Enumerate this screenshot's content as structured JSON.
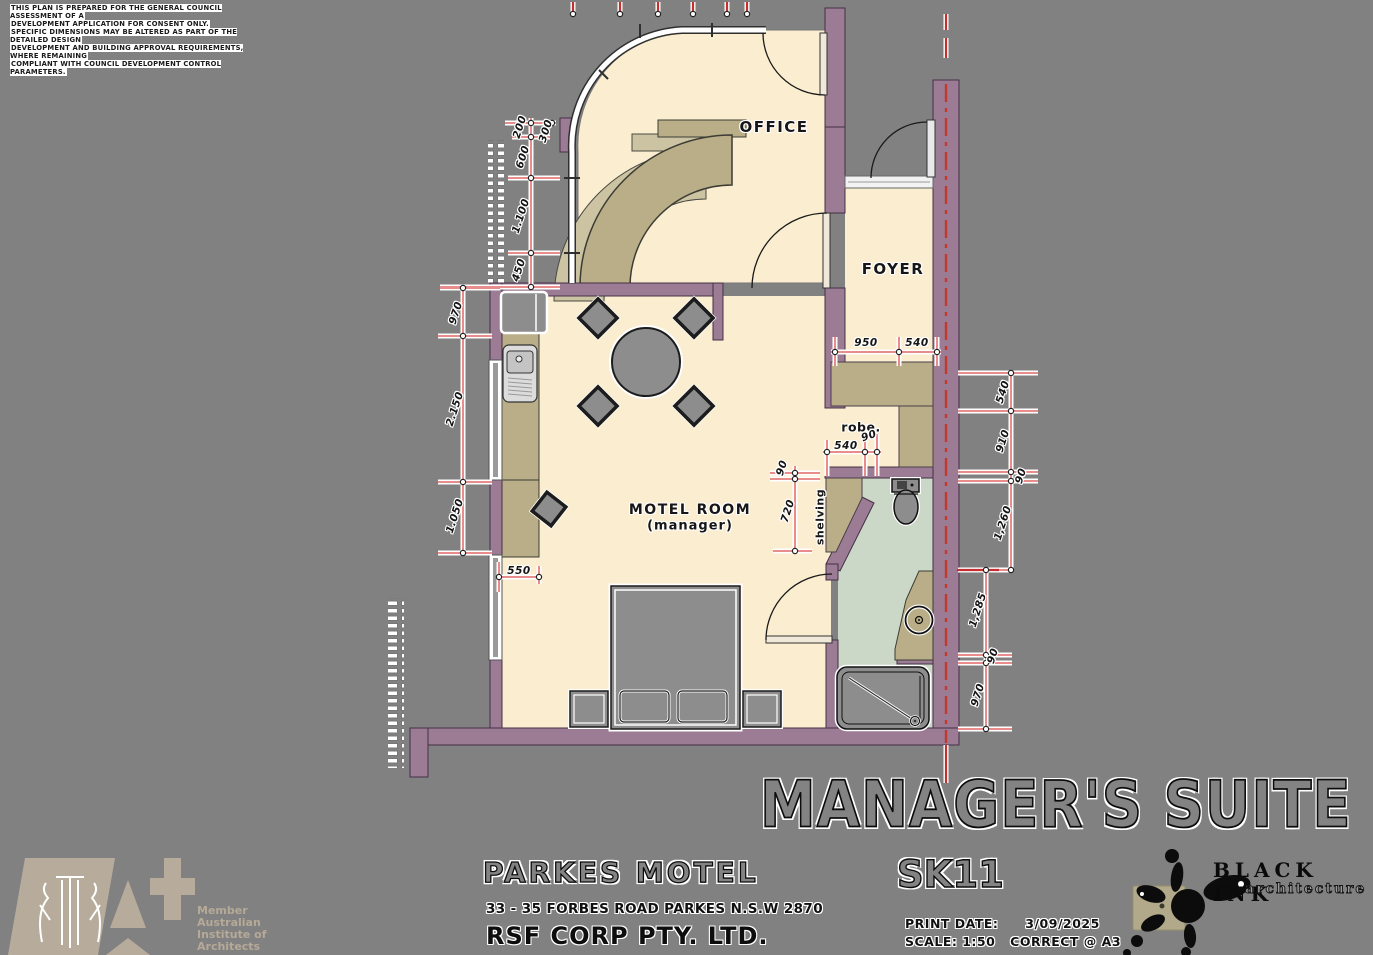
{
  "disclaimer_lines": [
    "THIS PLAN IS PREPARED FOR THE GENERAL COUNCIL ASSESSMENT OF A",
    "DEVELOPMENT APPLICATION FOR CONSENT ONLY.",
    "SPECIFIC DIMENSIONS MAY BE ALTERED AS PART OF THE DETAILED DESIGN",
    "DEVELOPMENT AND BUILDING APPROVAL REQUIREMENTS, WHERE REMAINING",
    "COMPLIANT WITH COUNCIL DEVELOPMENT CONTROL PARAMETERS."
  ],
  "plan": {
    "room_labels": {
      "office": "OFFICE",
      "foyer": "FOYER",
      "motel_room": "MOTEL ROOM",
      "motel_room_sub": "(manager)",
      "robe": "robe.",
      "shelving": "shelving"
    },
    "dimension_labels": [
      {
        "text": "200",
        "x": 520,
        "y": 127,
        "rot": -72
      },
      {
        "text": "300",
        "x": 546,
        "y": 131,
        "rot": -72
      },
      {
        "text": "600",
        "x": 523,
        "y": 157,
        "rot": -72
      },
      {
        "text": "1.100",
        "x": 521,
        "y": 216,
        "rot": -72
      },
      {
        "text": "450",
        "x": 519,
        "y": 270,
        "rot": -72
      },
      {
        "text": "970",
        "x": 456,
        "y": 313,
        "rot": -72
      },
      {
        "text": "2.150",
        "x": 455,
        "y": 409,
        "rot": -72
      },
      {
        "text": "1.050",
        "x": 455,
        "y": 516,
        "rot": -72
      },
      {
        "text": "550",
        "x": 519,
        "y": 571,
        "rot": 0
      },
      {
        "text": "950",
        "x": 866,
        "y": 343,
        "rot": 0
      },
      {
        "text": "540",
        "x": 917,
        "y": 343,
        "rot": 0
      },
      {
        "text": "540",
        "x": 846,
        "y": 446,
        "rot": 0
      },
      {
        "text": "90",
        "x": 869,
        "y": 436,
        "rot": -20
      },
      {
        "text": "90",
        "x": 782,
        "y": 468,
        "rot": -72
      },
      {
        "text": "720",
        "x": 788,
        "y": 511,
        "rot": -72
      },
      {
        "text": "540",
        "x": 1003,
        "y": 392,
        "rot": -72
      },
      {
        "text": "910",
        "x": 1003,
        "y": 441,
        "rot": -72
      },
      {
        "text": "90",
        "x": 1021,
        "y": 476,
        "rot": -72
      },
      {
        "text": "1,260",
        "x": 1003,
        "y": 523,
        "rot": -72
      },
      {
        "text": "1,285",
        "x": 978,
        "y": 610,
        "rot": -72
      },
      {
        "text": "90",
        "x": 993,
        "y": 656,
        "rot": -72
      },
      {
        "text": "970",
        "x": 978,
        "y": 695,
        "rot": -72
      }
    ]
  },
  "title_block": {
    "project_title": "MANAGER'S SUITE",
    "client_name": "PARKES MOTEL",
    "address": "33 - 35 FORBES ROAD PARKES N.S.W 2870",
    "company": "RSF CORP PTY. LTD.",
    "drawing_number": "SK11",
    "print_date_label": "PRINT DATE:",
    "print_date": "3/09/2025",
    "scale_label": "SCALE: 1:50",
    "scale_note": "CORRECT @ A3"
  },
  "logos": {
    "aia": {
      "member": "Member",
      "line1": "Australian",
      "line2": "Institute of",
      "line3": "Architects"
    },
    "black_ink": {
      "name": "BLACK INK",
      "sub": "architecture"
    }
  },
  "colors": {
    "background": "#818181",
    "wall": "#9c7c94",
    "floor_cream": "#fbeed0",
    "bathroom_sage": "#cbd7c7",
    "joinery_tan": "#b9ae88",
    "dimension_red": "#e98c8c",
    "boundary_red": "#c62f2f"
  }
}
